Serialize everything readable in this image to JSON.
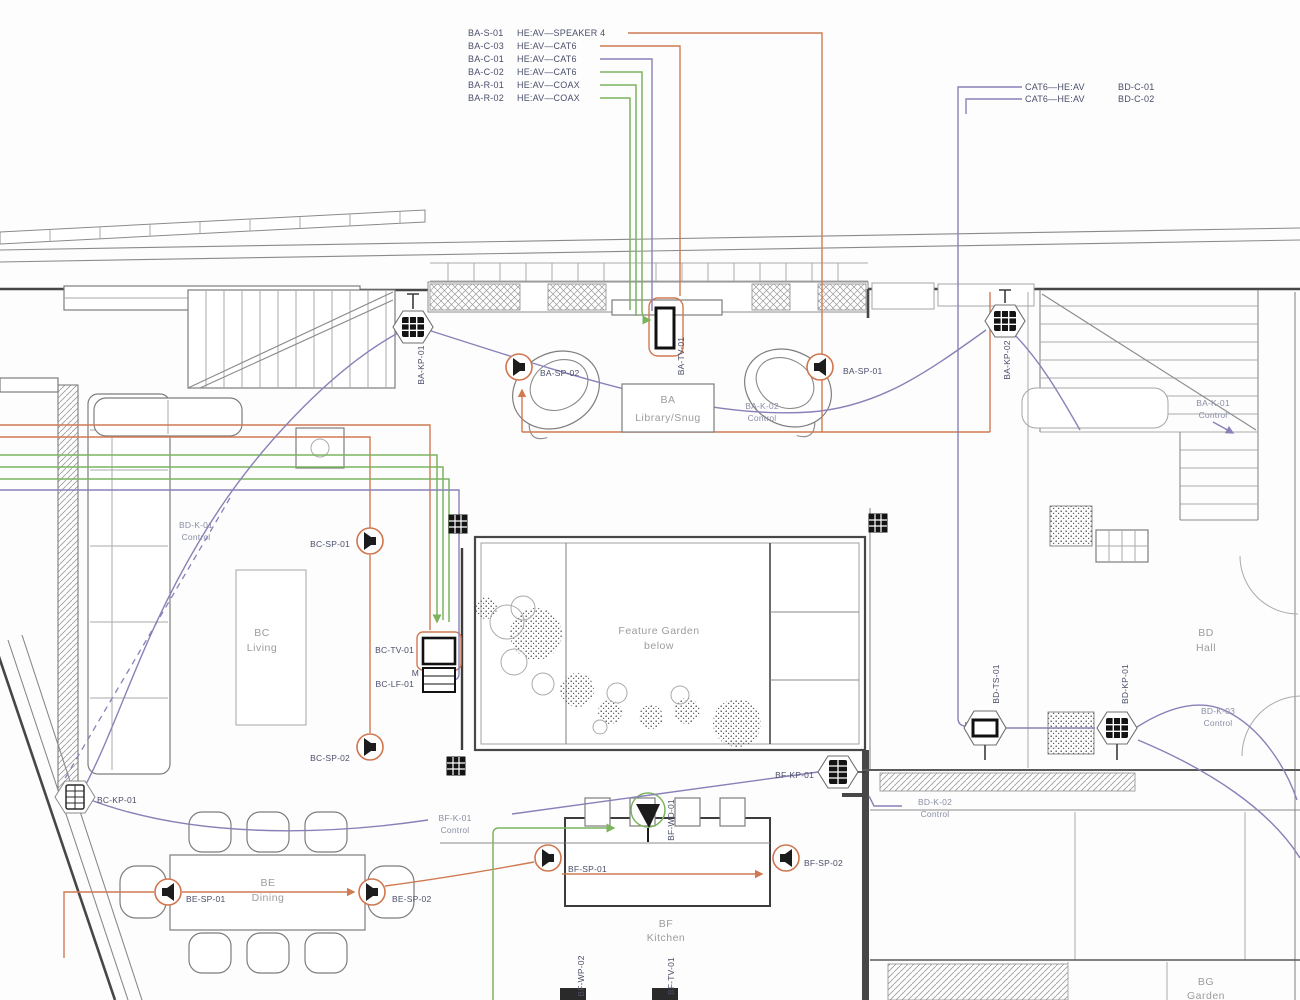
{
  "colors": {
    "orange": "#cf7a52",
    "green": "#7cb45e",
    "purple": "#8a80b8",
    "wall": "#7d7d7d",
    "wall_dark": "#474747",
    "device_label": "#4a4e69",
    "room_label": "#9c9c9c"
  },
  "legend_left": {
    "rows": [
      {
        "tag": "BA-S-01",
        "cable": "HE:AV—SPEAKER 4"
      },
      {
        "tag": "BA-C-03",
        "cable": "HE:AV—CAT6"
      },
      {
        "tag": "BA-C-01",
        "cable": "HE:AV—CAT6"
      },
      {
        "tag": "BA-C-02",
        "cable": "HE:AV—CAT6"
      },
      {
        "tag": "BA-R-01",
        "cable": "HE:AV—COAX"
      },
      {
        "tag": "BA-R-02",
        "cable": "HE:AV—COAX"
      }
    ]
  },
  "legend_right": {
    "rows": [
      {
        "cable": "CAT6—HE:AV",
        "tag": "BD-C-01"
      },
      {
        "cable": "CAT6—HE:AV",
        "tag": "BD-C-02"
      }
    ]
  },
  "rooms": {
    "ba": {
      "code": "BA",
      "name": "Library/Snug"
    },
    "bc": {
      "code": "BC",
      "name": "Living"
    },
    "bd": {
      "code": "BD",
      "name": "Hall"
    },
    "be": {
      "code": "BE",
      "name": "Dining"
    },
    "bf": {
      "code": "BF",
      "name": "Kitchen"
    },
    "bg": {
      "code": "BG",
      "name": "Garden"
    },
    "feature_garden": {
      "line1": "Feature Garden",
      "line2": "below"
    }
  },
  "devices": {
    "ba_kp_01": "BA-KP-01",
    "ba_kp_02": "BA-KP-02",
    "ba_sp_01": "BA-SP-01",
    "ba_sp_02": "BA-SP-02",
    "ba_tv_01": "BA-TV-01",
    "bc_sp_01": "BC-SP-01",
    "bc_sp_02": "BC-SP-02",
    "bc_tv_01": "BC-TV-01",
    "bc_lf_01_prefix": "M",
    "bc_lf_01": "BC-LF-01",
    "bc_kp_01": "BC-KP-01",
    "bd_ts_01": "BD-TS-01",
    "bd_kp_01": "BD-KP-01",
    "be_sp_01": "BE-SP-01",
    "be_sp_02": "BE-SP-02",
    "bf_kp_01": "BF-KP-01",
    "bf_sp_01": "BF-SP-01",
    "bf_sp_02": "BF-SP-02",
    "bf_wd_01": "BF-WD-01",
    "bf_wp_02": "BF-WP-02",
    "bf_tv_01": "BF-TV-01"
  },
  "controls": {
    "ba_k_01": {
      "id": "BA-K-01",
      "sub": "Control"
    },
    "ba_k_02": {
      "id": "BA-K-02",
      "sub": "Control"
    },
    "bd_k_01": {
      "id": "BD-K-01",
      "sub": "Control"
    },
    "bd_k_02": {
      "id": "BD-K-02",
      "sub": "Control"
    },
    "bd_k_03": {
      "id": "BD-K-03",
      "sub": "Control"
    },
    "bf_k_01": {
      "id": "BF-K-01",
      "sub": "Control"
    }
  }
}
